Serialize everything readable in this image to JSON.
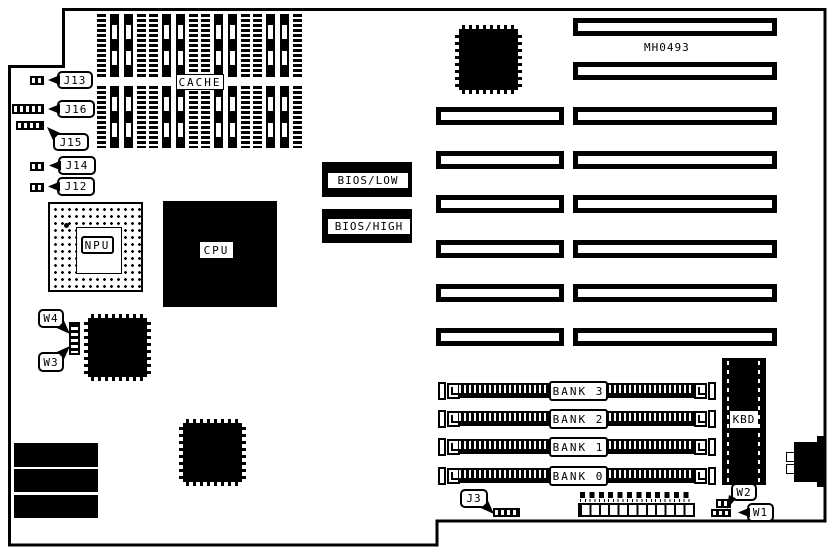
{
  "board": {
    "part_number": "MH0493"
  },
  "chips": {
    "cache": {
      "label": "CACHE"
    },
    "npu": {
      "label": "NPU"
    },
    "cpu": {
      "label": "CPU"
    },
    "bios_low": {
      "label": "BIOS/LOW"
    },
    "bios_high": {
      "label": "BIOS/HIGH"
    },
    "kbd": {
      "label": "KBD"
    }
  },
  "jumpers": {
    "j13": {
      "label": "J13"
    },
    "j16": {
      "label": "J16"
    },
    "j15": {
      "label": "J15"
    },
    "j14": {
      "label": "J14"
    },
    "j12": {
      "label": "J12"
    },
    "j3": {
      "label": "J3"
    },
    "w1": {
      "label": "W1"
    },
    "w2": {
      "label": "W2"
    },
    "w3": {
      "label": "W3"
    },
    "w4": {
      "label": "W4"
    }
  },
  "memory_banks": [
    {
      "label": "BANK 3"
    },
    {
      "label": "BANK 2"
    },
    {
      "label": "BANK 1"
    },
    {
      "label": "BANK 0"
    }
  ],
  "colors": {
    "ink": "#000000",
    "background": "#ffffff"
  }
}
